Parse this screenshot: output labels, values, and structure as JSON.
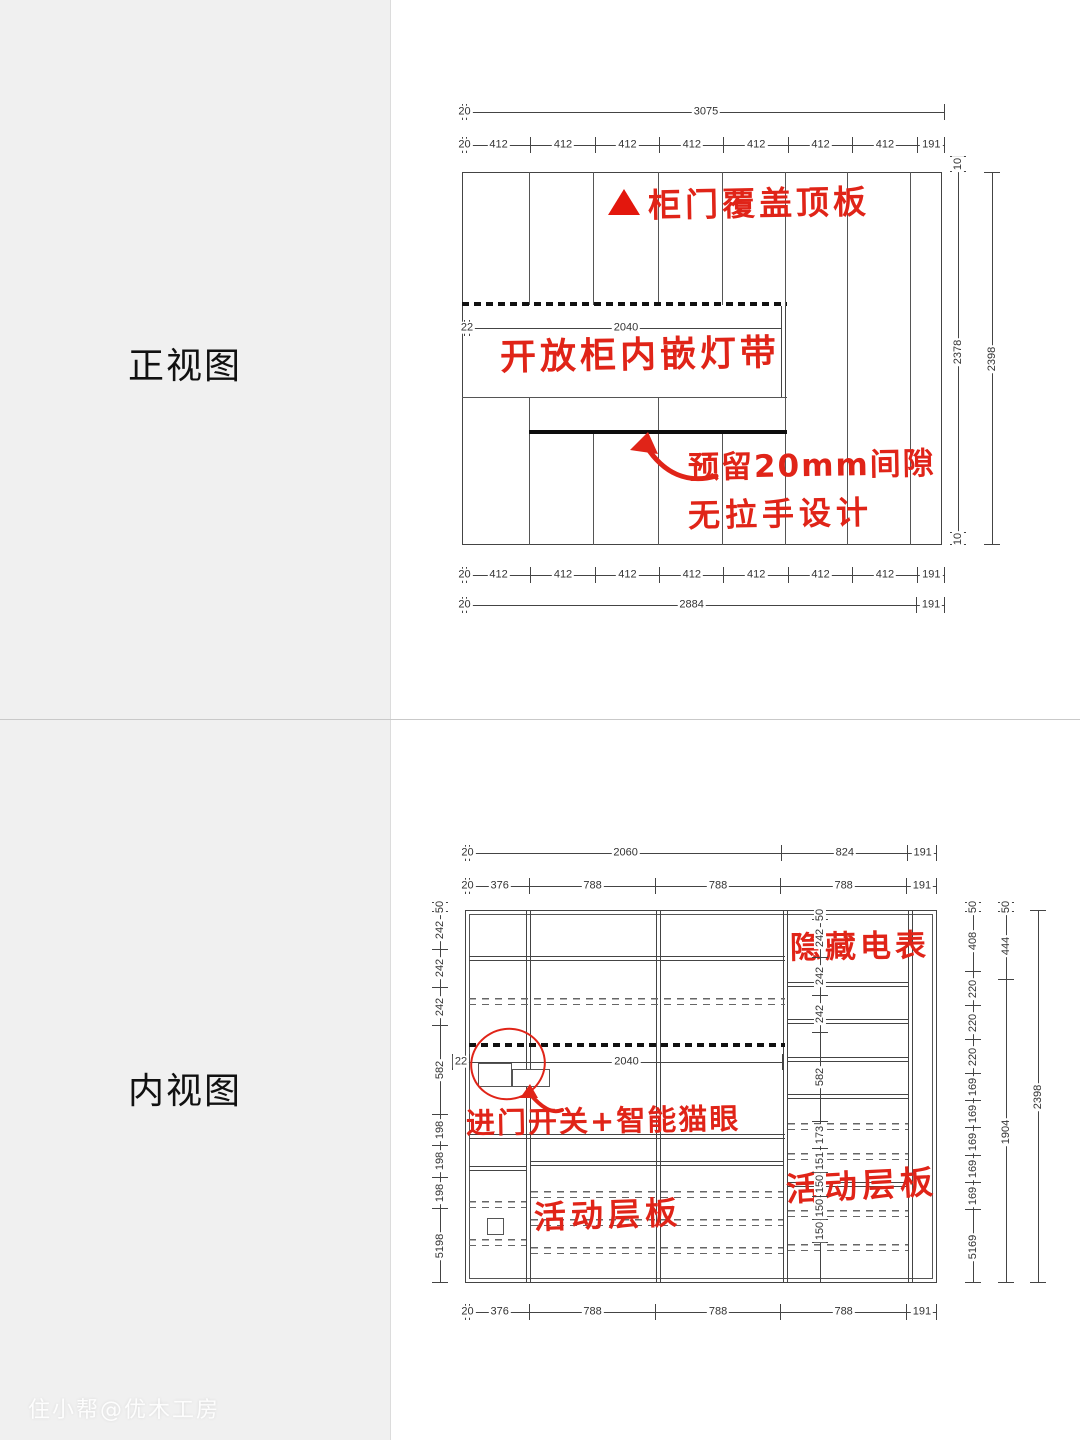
{
  "watermark": "住小帮@优木工房",
  "colors": {
    "annotation_red": "#e02418",
    "line": "#444444",
    "side_band_bg": "#f0f0f0"
  },
  "front_view": {
    "label": "正视图",
    "annotations": {
      "roof": "柜门覆盖顶板",
      "led": "开放柜内嵌灯带",
      "gap_line1": "预留20mm间隙",
      "gap_line2": "无拉手设计"
    },
    "dims": {
      "top1": [
        "20",
        "3075"
      ],
      "top2": [
        "20",
        "412",
        "412",
        "412",
        "412",
        "412",
        "412",
        "412",
        "191"
      ],
      "mid": [
        "22",
        "2040"
      ],
      "bottom1": [
        "20",
        "412",
        "412",
        "412",
        "412",
        "412",
        "412",
        "412",
        "191"
      ],
      "bottom2": [
        "20",
        "2884",
        "191"
      ],
      "right_inner": [
        "10",
        "2378",
        "10"
      ],
      "right_outer": [
        "2398"
      ]
    }
  },
  "interior_view": {
    "label": "内视图",
    "annotations": {
      "meter": "隐藏电表",
      "switch": "进门开关+智能猫眼",
      "shelf_mid": "活动层板",
      "shelf_right": "活动层板"
    },
    "dims": {
      "top1": [
        "20",
        "2060",
        "824",
        "191"
      ],
      "top2": [
        "20",
        "376",
        "788",
        "788",
        "788",
        "191"
      ],
      "mid": [
        "22",
        "2040"
      ],
      "bottom": [
        "20",
        "376",
        "788",
        "788",
        "788",
        "191"
      ],
      "left": [
        "50",
        "242",
        "242",
        "242",
        "582",
        "198",
        "198",
        "198",
        "5198"
      ],
      "center": [
        "50",
        "242",
        "242",
        "242",
        "582",
        "173",
        "151",
        "150",
        "150",
        "150",
        ""
      ],
      "right_inner": [
        "50",
        "408",
        "220",
        "220",
        "220",
        "169",
        "169",
        "169",
        "169",
        "169",
        "5169"
      ],
      "right_mid": [
        "50",
        "444",
        "1904"
      ],
      "right_outer": [
        "2398"
      ]
    }
  }
}
